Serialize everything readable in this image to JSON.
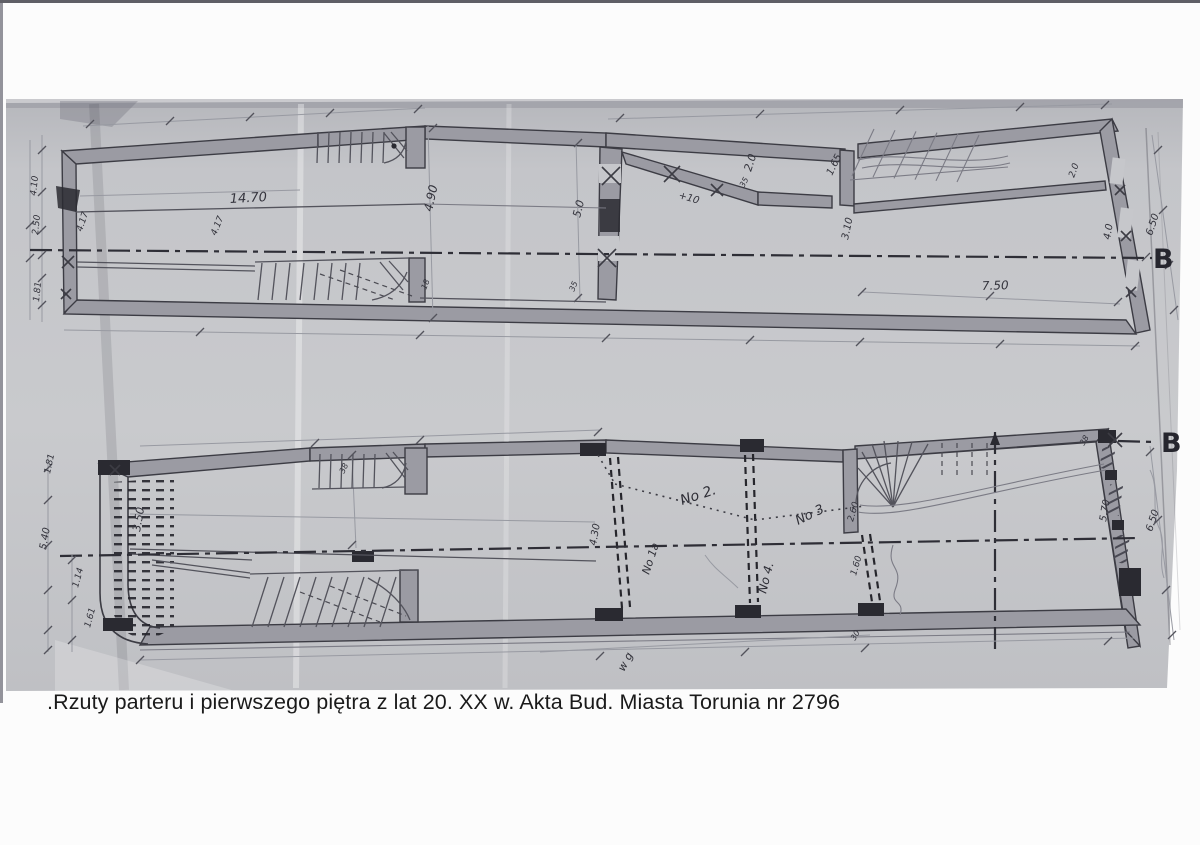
{
  "page": {
    "caption": ".Rzuty parteru i pierwszego piętra z lat 20. XX w. Akta Bud. Miasta Torunia nr 2796"
  },
  "colors": {
    "photo_gray": "#c2c3c7",
    "drawing_line": "#3b3b43",
    "wall_fill": "#9b9ba3",
    "pier_dark": "#2a2a31",
    "caption_text": "#1a1a1a"
  },
  "drawing": {
    "section_labels": [
      {
        "t": "B",
        "x": 1153,
        "y": 268
      },
      {
        "t": "B",
        "x": 1161,
        "y": 452
      }
    ],
    "annotations": [
      {
        "t": "14.70",
        "x": 230,
        "y": 203,
        "r": -3,
        "s": 13
      },
      {
        "t": "4.90",
        "x": 432,
        "y": 212,
        "r": -78,
        "s": 12
      },
      {
        "t": "4.17",
        "x": 82,
        "y": 232,
        "r": -72,
        "s": 9
      },
      {
        "t": "4.17",
        "x": 216,
        "y": 236,
        "r": -68,
        "s": 9
      },
      {
        "t": "2.50",
        "x": 38,
        "y": 235,
        "r": -84,
        "s": 9
      },
      {
        "t": "4.10",
        "x": 36,
        "y": 196,
        "r": -84,
        "s": 9
      },
      {
        "t": "1.81",
        "x": 39,
        "y": 302,
        "r": -84,
        "s": 9
      },
      {
        "t": "5.0",
        "x": 580,
        "y": 218,
        "r": -76,
        "s": 11
      },
      {
        "t": "35",
        "x": 574,
        "y": 292,
        "r": -68,
        "s": 8
      },
      {
        "t": "18",
        "x": 426,
        "y": 290,
        "r": -68,
        "s": 8
      },
      {
        "t": "+10",
        "x": 678,
        "y": 198,
        "r": 16,
        "s": 10
      },
      {
        "t": "2.0",
        "x": 751,
        "y": 172,
        "r": -72,
        "s": 11
      },
      {
        "t": "35",
        "x": 744,
        "y": 188,
        "r": -62,
        "s": 8
      },
      {
        "t": "1.65",
        "x": 832,
        "y": 176,
        "r": -64,
        "s": 10
      },
      {
        "t": "3.10",
        "x": 848,
        "y": 240,
        "r": -78,
        "s": 10
      },
      {
        "t": "7.50",
        "x": 982,
        "y": 290,
        "r": -2,
        "s": 12
      },
      {
        "t": "4.0",
        "x": 1110,
        "y": 240,
        "r": -80,
        "s": 10
      },
      {
        "t": "6.50",
        "x": 1152,
        "y": 236,
        "r": -72,
        "s": 10
      },
      {
        "t": "2.0",
        "x": 1074,
        "y": 178,
        "r": -70,
        "s": 9
      },
      {
        "t": "3.50",
        "x": 140,
        "y": 532,
        "r": -80,
        "s": 11
      },
      {
        "t": "5.40",
        "x": 46,
        "y": 550,
        "r": -80,
        "s": 10
      },
      {
        "t": "1.81",
        "x": 50,
        "y": 474,
        "r": -78,
        "s": 9
      },
      {
        "t": "1.14",
        "x": 78,
        "y": 588,
        "r": -75,
        "s": 9
      },
      {
        "t": "1.61",
        "x": 90,
        "y": 628,
        "r": -75,
        "s": 9
      },
      {
        "t": "38",
        "x": 344,
        "y": 474,
        "r": -64,
        "s": 8
      },
      {
        "t": "4.30",
        "x": 596,
        "y": 546,
        "r": -80,
        "s": 10
      },
      {
        "t": "2.60",
        "x": 853,
        "y": 522,
        "r": -74,
        "s": 9
      },
      {
        "t": "1.60",
        "x": 856,
        "y": 576,
        "r": -74,
        "s": 9
      },
      {
        "t": "5.70",
        "x": 1106,
        "y": 522,
        "r": -80,
        "s": 10
      },
      {
        "t": "6.50",
        "x": 1152,
        "y": 532,
        "r": -72,
        "s": 10
      },
      {
        "t": "38",
        "x": 1084,
        "y": 446,
        "r": -60,
        "s": 8
      },
      {
        "t": "30",
        "x": 855,
        "y": 641,
        "r": -60,
        "s": 8
      },
      {
        "t": "No 2.",
        "x": 682,
        "y": 505,
        "r": -18,
        "s": 14,
        "h": true
      },
      {
        "t": "No 3",
        "x": 798,
        "y": 525,
        "r": -26,
        "s": 13,
        "h": true
      },
      {
        "t": "No 4.",
        "x": 766,
        "y": 594,
        "r": -76,
        "s": 12,
        "h": true
      },
      {
        "t": "No 1a",
        "x": 649,
        "y": 575,
        "r": -72,
        "s": 11,
        "h": true
      },
      {
        "t": "w g",
        "x": 624,
        "y": 672,
        "r": -62,
        "s": 11,
        "h": true
      }
    ]
  }
}
